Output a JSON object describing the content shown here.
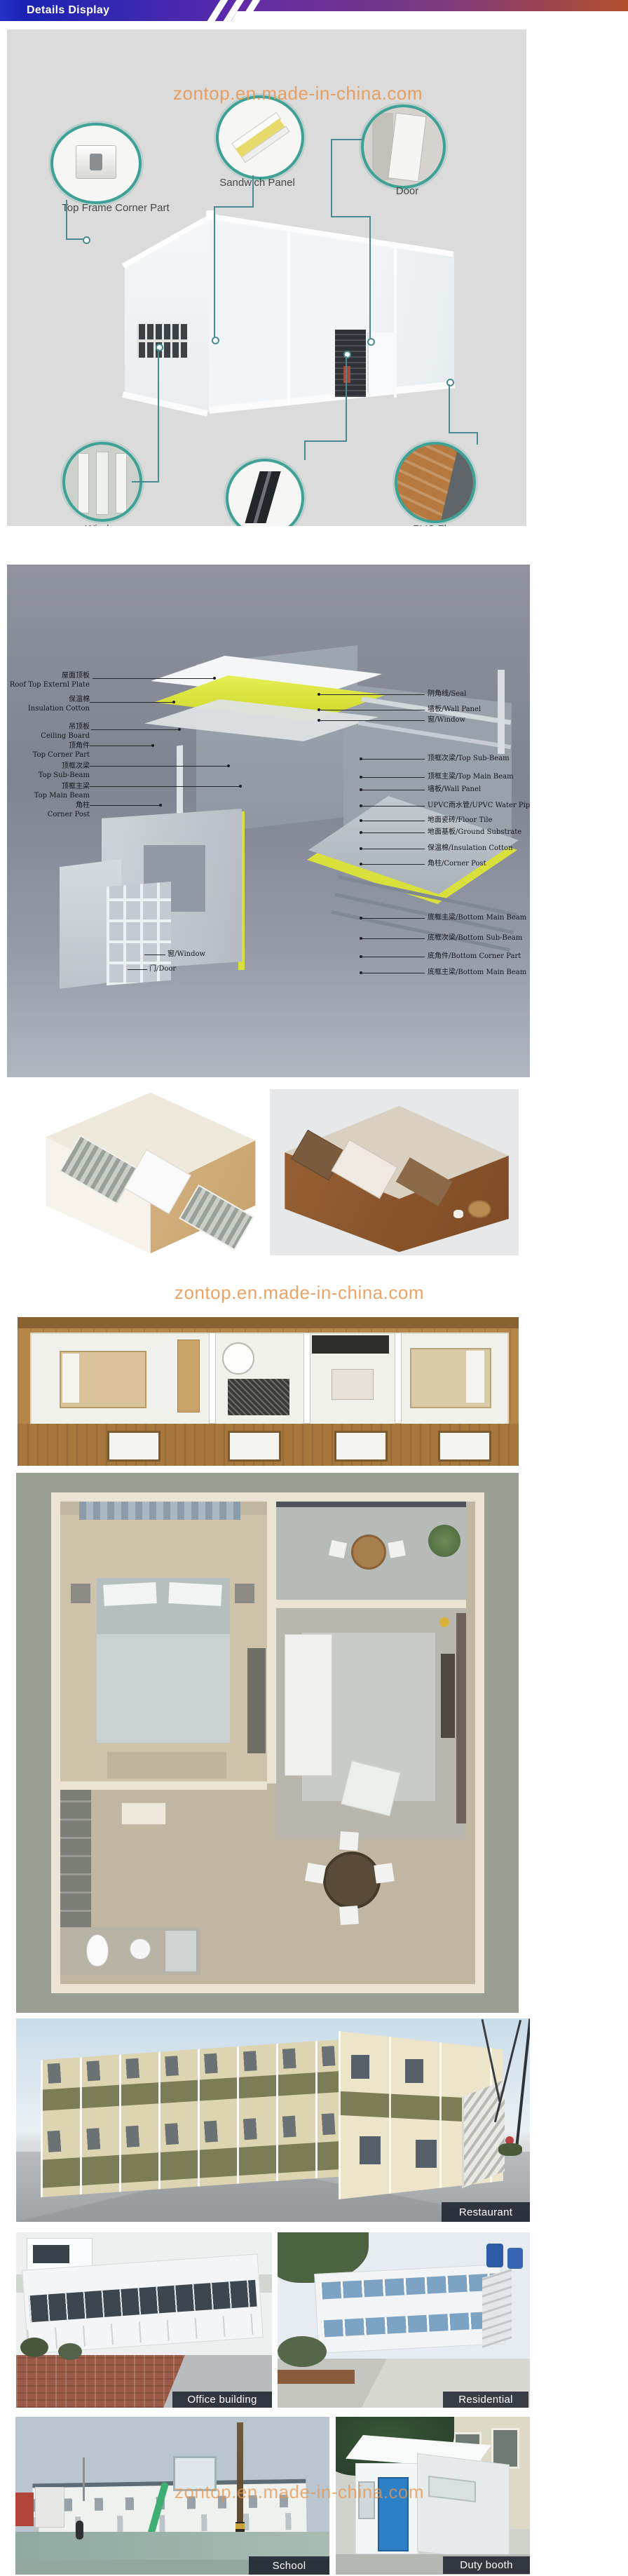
{
  "header": {
    "title": "Details Display"
  },
  "watermark": {
    "text": "zontop.en.made-in-china.com"
  },
  "components": {
    "top_frame_corner_part": "Top Frame Corner Part",
    "sandwich_panel": "Sandwich Panel",
    "door": "Door",
    "window": "Window",
    "corner_column": "Corner Column",
    "pvc_floor": "PVC Floor"
  },
  "exploded": {
    "left_labels": [
      {
        "zh": "屋面顶板",
        "en": "Roof Top Externl Plate"
      },
      {
        "zh": "保温棉",
        "en": "Insulation Cotton"
      },
      {
        "zh": "吊顶板",
        "en": "Ceiling Board"
      },
      {
        "zh": "顶角件",
        "en": "Top Corner Part"
      },
      {
        "zh": "顶框次梁",
        "en": "Top Sub-Beam"
      },
      {
        "zh": "顶框主梁",
        "en": "Top Main Beam"
      },
      {
        "zh": "角柱",
        "en": "Corner Post"
      }
    ],
    "inner_labels": [
      "窗/Window",
      "门/Door"
    ],
    "right_labels": [
      "阴角线/Seal",
      "墙板/Wall Panel",
      "窗/Window",
      "顶框次梁/Top Sub-Beam",
      "顶框主梁/Top Main Beam",
      "墙板/Wall Panel",
      "UPVC雨水管/UPVC Water Pipe",
      "地面瓷砖/Floor Tile",
      "地面基板/Ground Substrate",
      "保温棉/Insulation Cotton",
      "角柱/Corner Post",
      "底框主梁/Bottom Main Beam",
      "底框次梁/Bottom Sub-Beam",
      "底角件/Bottom Corner Part",
      "底框主梁/Bottom Main Beam"
    ]
  },
  "gallery": {
    "restaurant": "Restaurant",
    "office_building": "Office building",
    "residential": "Residential",
    "school": "School",
    "duty_booth": "Duty booth"
  },
  "colors": {
    "banner_blue": "#1a23b2",
    "banner_purple": "#5e2aab",
    "banner_orange": "#b34e2c",
    "teal_ring": "#3fa096",
    "watermark_orange": "#e8954d",
    "accent_yellow": "#d9e03c",
    "label_box_bg": "#141a26"
  }
}
